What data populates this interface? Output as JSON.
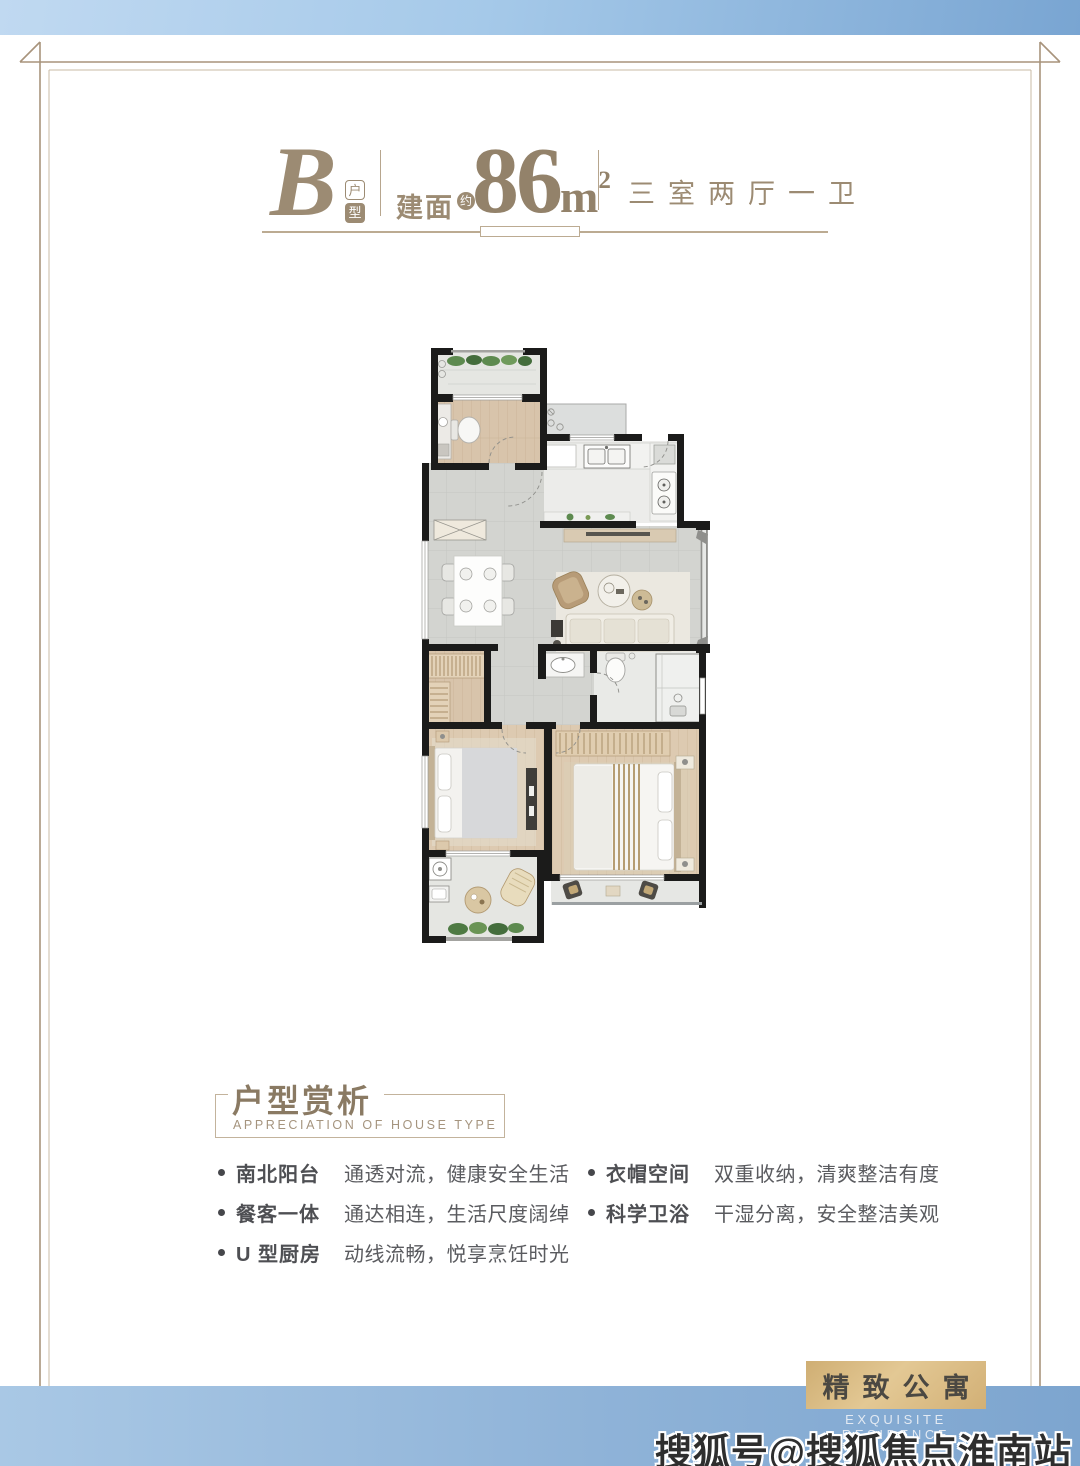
{
  "header": {
    "letter": "B",
    "letter_badge_top": "户",
    "letter_badge_bottom": "型",
    "area_label": "建面",
    "area_approx": "约",
    "area_number": "86",
    "area_unit": "m",
    "area_sup": "2",
    "layout": "三室两厅一卫"
  },
  "analysis": {
    "title": "户型赏析",
    "subtitle": "APPRECIATION OF HOUSE TYPE",
    "features_left": [
      {
        "label": "南北阳台",
        "desc": "通透对流，健康安全生活"
      },
      {
        "label": "餐客一体",
        "desc": "通达相连，生活尺度阔绰"
      },
      {
        "label": "U 型厨房",
        "desc": "动线流畅，悦享烹饪时光"
      }
    ],
    "features_right": [
      {
        "label": "衣帽空间",
        "desc": "双重收纳，清爽整洁有度"
      },
      {
        "label": "科学卫浴",
        "desc": "干湿分离，安全整洁美观"
      }
    ]
  },
  "badge": {
    "title": "精致公寓",
    "subtitle": "EXQUISITE RESIDENCE"
  },
  "watermark": "搜狐号@搜狐焦点淮南站",
  "colors": {
    "accent_taupe": "#9c8b73",
    "band_blue_light": "#b9d4ee",
    "band_blue_dark": "#7fa9d4",
    "badge_gold": "#d4b37c",
    "wall_black": "#1b1b1a"
  }
}
